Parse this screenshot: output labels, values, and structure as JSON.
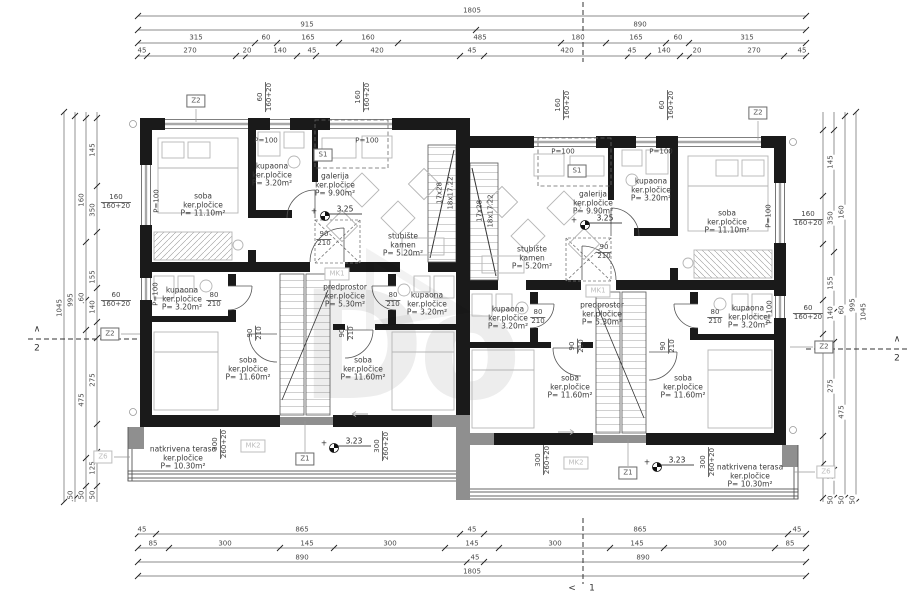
{
  "watermark": "Do",
  "dims": {
    "top": {
      "r1": [
        "1805"
      ],
      "r2": [
        "915",
        "890"
      ],
      "r3": [
        "315",
        "60",
        "165",
        "160",
        "485",
        "180",
        "165",
        "60",
        "315"
      ],
      "r4": [
        "45",
        "270",
        "20",
        "140",
        "45",
        "420",
        "45",
        "420",
        "45",
        "140",
        "20",
        "270",
        "45"
      ]
    },
    "bottom": {
      "r1": [
        "45",
        "865",
        "45",
        "865",
        "45"
      ],
      "r2": [
        "85",
        "300",
        "145",
        "300",
        "145",
        "300",
        "145",
        "300",
        "85"
      ],
      "r3": [
        "890",
        "45",
        "890"
      ],
      "r4": [
        "1805"
      ]
    },
    "side": {
      "total": "1045",
      "sub": "995",
      "line3": [
        "160",
        "60",
        "475"
      ],
      "inner": [
        "145",
        "350",
        "155",
        "140",
        "275",
        "125"
      ],
      "offset": "50"
    }
  },
  "rooms": {
    "soba_vel": {
      "name": "soba",
      "finish": "ker.pločice",
      "area": "P= 11.10m²"
    },
    "kupaona": {
      "name": "kupaona",
      "finish": "ker.pločice",
      "area": "P= 3.20m²"
    },
    "galerija": {
      "name": "galerija",
      "finish": "ker.pločice",
      "area": "P= 9.90m²"
    },
    "stubiste": {
      "name": "stubište",
      "finish": "kamen",
      "area": "P= 5.20m²"
    },
    "predprostor": {
      "name": "predprostor",
      "finish": "ker.pločice",
      "area": "P= 5.30m²"
    },
    "soba_mid": {
      "name": "soba",
      "finish": "ker.pločice",
      "area": "P= 11.60m²"
    },
    "terasa": {
      "name": "natkrivena terasa",
      "finish": "ker.pločice",
      "area": "P= 10.30m²"
    }
  },
  "markers": {
    "z2": "Z2",
    "z6": "Z6",
    "z1": "Z1",
    "s1": "S1",
    "mk1": "MK1",
    "mk2": "MK2"
  },
  "sections": {
    "one": "1",
    "two": "2",
    "chevron_up": "∧",
    "chevron_left": "<"
  },
  "levels": {
    "upper": "3.25",
    "terrace": "3.23",
    "plus": "+"
  },
  "windows": {
    "w160": {
      "a": "160",
      "b": "160+20"
    },
    "w60": {
      "a": "60",
      "b": "160+20"
    },
    "w300": {
      "a": "300",
      "b": "260+20"
    }
  },
  "doors": {
    "d90": {
      "a": "90",
      "b": "210"
    },
    "d80": {
      "a": "80",
      "b": "210"
    }
  },
  "stairs": {
    "a": "17x28",
    "b": "18x17.22"
  },
  "parapet": "P=100"
}
